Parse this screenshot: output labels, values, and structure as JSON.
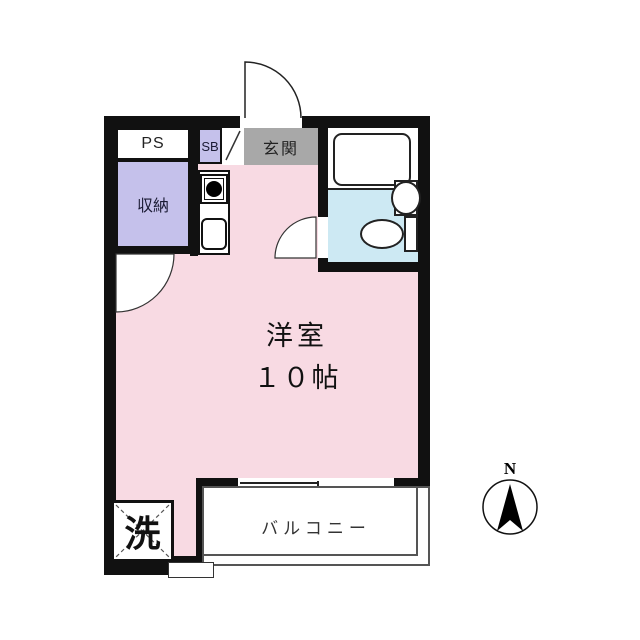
{
  "plan": {
    "labels": {
      "ps": "PS",
      "sb": "SB",
      "entry": "玄関",
      "storage": "収納",
      "laundry": "洗",
      "balcony": "バルコニー"
    },
    "main_room": {
      "name": "洋室",
      "size": "１０帖"
    },
    "compass": {
      "north_label": "N"
    },
    "colors": {
      "room_pink": "#f8dae3",
      "closet_lavender": "#c5c1eb",
      "entry_gray": "#a8a8a8",
      "bath_blue": "#cde9f3",
      "wall_black": "#111111"
    }
  }
}
